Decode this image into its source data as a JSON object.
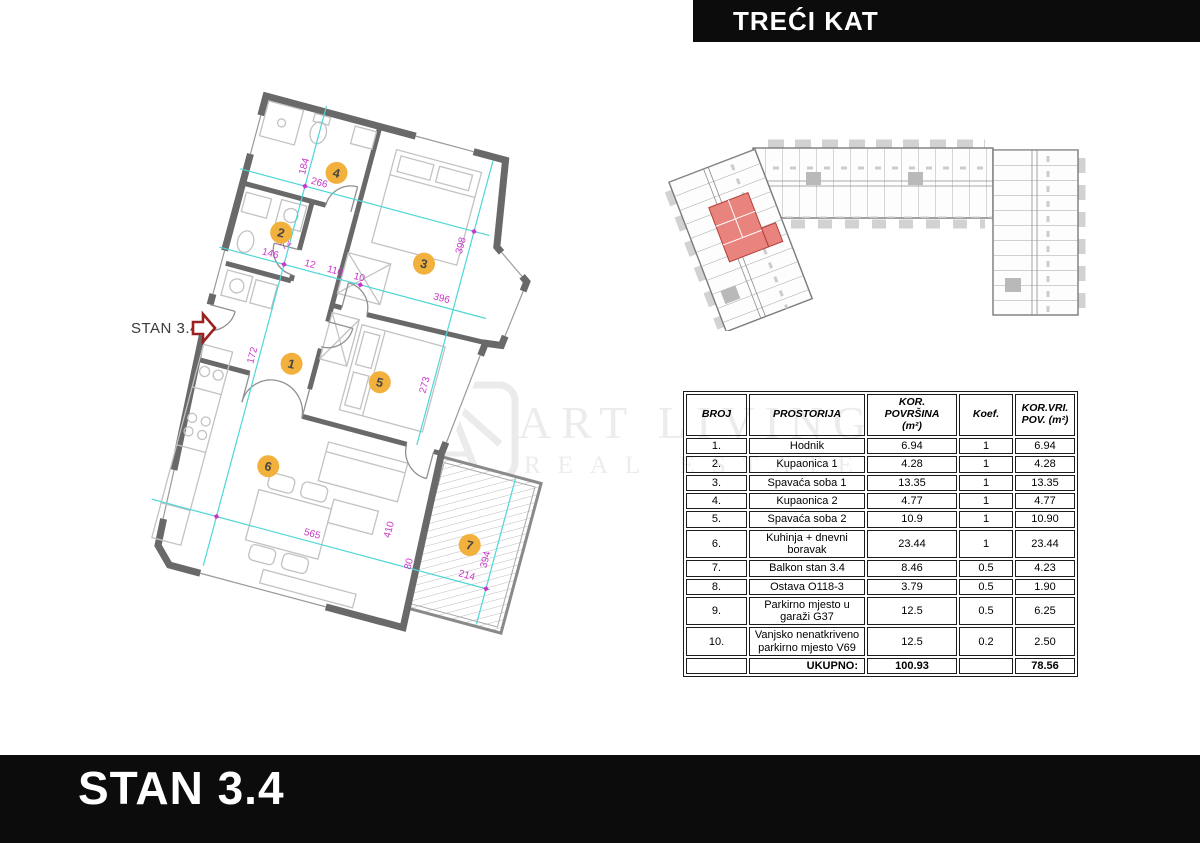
{
  "header_banner": {
    "label": "TREĆI KAT"
  },
  "footer_banner": {
    "label": "STAN 3.4"
  },
  "watermark": {
    "line1": "ART LIVING",
    "line2": "REAL ESTATE"
  },
  "plan": {
    "entry_label": "STAN 3.4",
    "room_markers": [
      "1",
      "2",
      "3",
      "4",
      "5",
      "6",
      "7"
    ],
    "dimensions": [
      "184",
      "266",
      "72",
      "146",
      "12",
      "110",
      "10",
      "396",
      "398",
      "172",
      "273",
      "565",
      "410",
      "80",
      "214",
      "394"
    ],
    "colors": {
      "wall": "#696969",
      "marker_fill": "#f1b13c",
      "dimension_line": "#4fd6d6",
      "dimension_text": "#c937c9",
      "entry_arrow": "#9b2020"
    }
  },
  "overview_map": {
    "highlight_color": "#e8837d"
  },
  "table": {
    "headers": [
      "BROJ",
      "PROSTORIJA",
      "KOR.\nPOVRŠINA\n(m²)",
      "Koef.",
      "KOR.VRI.\nPOV. (m²)"
    ],
    "rows": [
      {
        "broj": "1.",
        "prostorija": "Hodnik",
        "povrsina": "6.94",
        "koef": "1",
        "vrijednost": "6.94"
      },
      {
        "broj": "2.",
        "prostorija": "Kupaonica 1",
        "povrsina": "4.28",
        "koef": "1",
        "vrijednost": "4.28"
      },
      {
        "broj": "3.",
        "prostorija": "Spavaća soba 1",
        "povrsina": "13.35",
        "koef": "1",
        "vrijednost": "13.35"
      },
      {
        "broj": "4.",
        "prostorija": "Kupaonica 2",
        "povrsina": "4.77",
        "koef": "1",
        "vrijednost": "4.77"
      },
      {
        "broj": "5.",
        "prostorija": "Spavaća soba 2",
        "povrsina": "10.9",
        "koef": "1",
        "vrijednost": "10.90"
      },
      {
        "broj": "6.",
        "prostorija": "Kuhinja + dnevni boravak",
        "povrsina": "23.44",
        "koef": "1",
        "vrijednost": "23.44"
      },
      {
        "broj": "7.",
        "prostorija": "Balkon stan 3.4",
        "povrsina": "8.46",
        "koef": "0.5",
        "vrijednost": "4.23"
      },
      {
        "broj": "8.",
        "prostorija": "Ostava O118-3",
        "povrsina": "3.79",
        "koef": "0.5",
        "vrijednost": "1.90"
      },
      {
        "broj": "9.",
        "prostorija": "Parkirno mjesto u garaži G37",
        "povrsina": "12.5",
        "koef": "0.5",
        "vrijednost": "6.25"
      },
      {
        "broj": "10.",
        "prostorija": "Vanjsko nenatkriveno parkirno mjesto V69",
        "povrsina": "12.5",
        "koef": "0.2",
        "vrijednost": "2.50"
      }
    ],
    "total": {
      "label": "UKUPNO:",
      "povrsina": "100.93",
      "vrijednost": "78.56"
    }
  }
}
